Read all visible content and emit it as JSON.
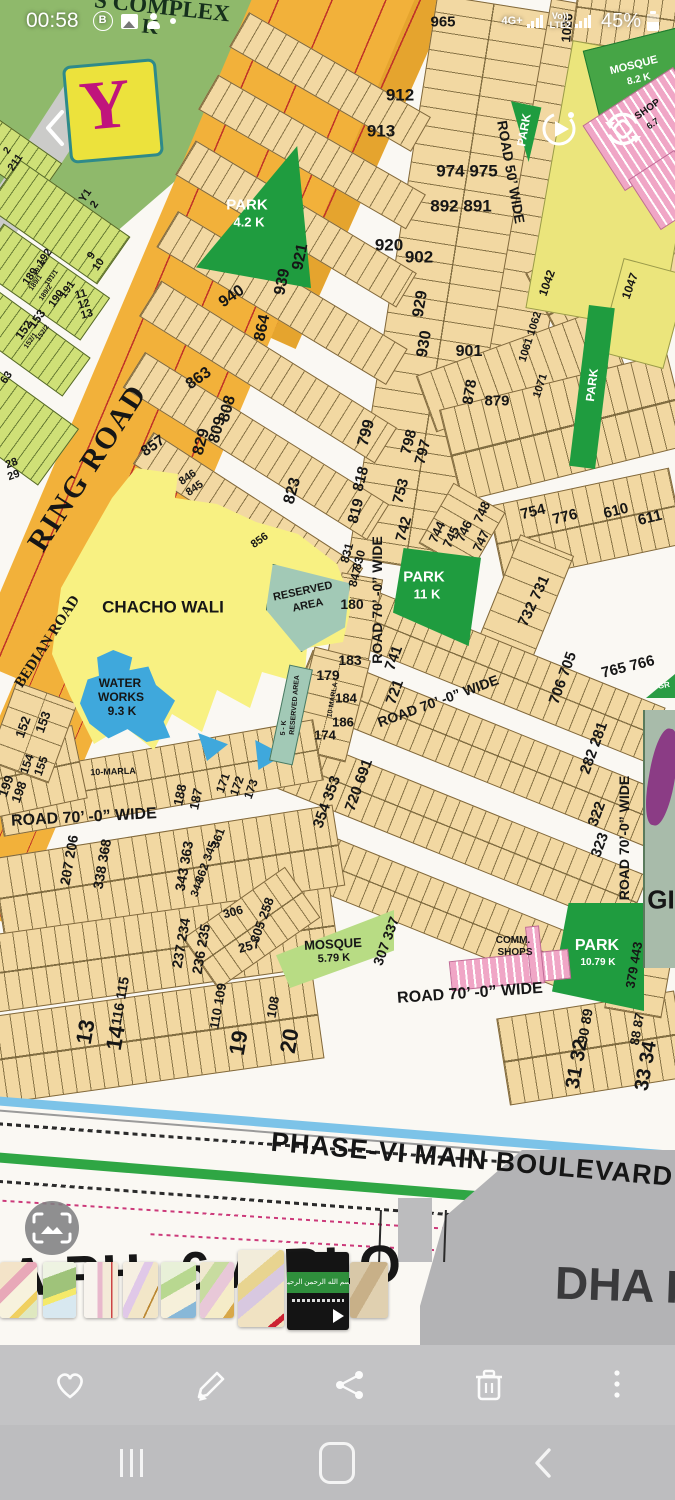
{
  "status_bar": {
    "time": "00:58",
    "network": "4G+",
    "volte": "Vo))",
    "lte": "LTE2",
    "battery": "45%",
    "notification_icons": [
      "b-app-icon",
      "gallery-icon",
      "digital-wellbeing-icon",
      "notification-dot"
    ]
  },
  "gallery": {
    "top_controls": [
      "back",
      "motion-photo",
      "rotate"
    ],
    "actions": [
      "favorite",
      "edit",
      "share",
      "delete",
      "more"
    ]
  },
  "nav_bar": {
    "items": [
      "recents",
      "home",
      "back"
    ]
  },
  "filmstrip": {
    "video_band_text": "بسم الله الرحمن الرحيم",
    "thumbs": [
      {
        "kind": "map",
        "x": 0,
        "y": 1262,
        "w": 37,
        "h": 56,
        "style": "th0"
      },
      {
        "kind": "map",
        "x": 43,
        "y": 1262,
        "w": 33,
        "h": 56,
        "style": "th1"
      },
      {
        "kind": "map",
        "x": 84,
        "y": 1262,
        "w": 34,
        "h": 56,
        "style": "th2"
      },
      {
        "kind": "map",
        "x": 123,
        "y": 1262,
        "w": 35,
        "h": 56,
        "style": "th3"
      },
      {
        "kind": "map",
        "x": 161,
        "y": 1262,
        "w": 35,
        "h": 56,
        "style": "th4"
      },
      {
        "kind": "map",
        "x": 200,
        "y": 1262,
        "w": 34,
        "h": 56,
        "style": "th5"
      },
      {
        "kind": "map",
        "x": 238,
        "y": 1250,
        "w": 46,
        "h": 77,
        "style": "th6"
      },
      {
        "kind": "video",
        "x": 287,
        "y": 1252,
        "w": 62,
        "h": 78,
        "style": "thv"
      },
      {
        "kind": "map",
        "x": 350,
        "y": 1262,
        "w": 38,
        "h": 56,
        "style": "th7"
      }
    ]
  },
  "map": {
    "logo": "Y",
    "bottom_title_partial": "A PH -6 A BLO",
    "next_image_title": "DHA P",
    "labels": [
      {
        "t": "S COMPLEX",
        "x": 162,
        "y": 7,
        "r": 6,
        "s": 23,
        "c": "#16301c",
        "f": 1
      },
      {
        "t": "K",
        "x": 150,
        "y": 27,
        "r": 6,
        "s": 21,
        "c": "#16301c",
        "f": 1
      },
      {
        "t": "965",
        "x": 443,
        "y": 22,
        "r": 0,
        "s": 15
      },
      {
        "t": "1026",
        "x": 567,
        "y": 28,
        "r": -85,
        "s": 13
      },
      {
        "t": "912",
        "x": 400,
        "y": 95,
        "r": 0,
        "s": 17
      },
      {
        "t": "913",
        "x": 381,
        "y": 131,
        "r": 0,
        "s": 17
      },
      {
        "t": "974 975",
        "x": 467,
        "y": 171,
        "r": 0,
        "s": 17
      },
      {
        "t": "892 891",
        "x": 461,
        "y": 206,
        "r": 0,
        "s": 17
      },
      {
        "t": "920",
        "x": 389,
        "y": 245,
        "r": 0,
        "s": 17
      },
      {
        "t": "902",
        "x": 419,
        "y": 257,
        "r": 0,
        "s": 17
      },
      {
        "t": "921",
        "x": 301,
        "y": 257,
        "r": -78,
        "s": 16
      },
      {
        "t": "939",
        "x": 283,
        "y": 282,
        "r": -78,
        "s": 16
      },
      {
        "t": "940",
        "x": 232,
        "y": 297,
        "r": -35,
        "s": 16
      },
      {
        "t": "864",
        "x": 263,
        "y": 328,
        "r": -78,
        "s": 16
      },
      {
        "t": "929",
        "x": 421,
        "y": 304,
        "r": -80,
        "s": 16
      },
      {
        "t": "930",
        "x": 425,
        "y": 344,
        "r": -80,
        "s": 16
      },
      {
        "t": "901",
        "x": 469,
        "y": 352,
        "r": 0,
        "s": 16
      },
      {
        "t": "863",
        "x": 199,
        "y": 379,
        "r": -35,
        "s": 16
      },
      {
        "t": "808",
        "x": 228,
        "y": 409,
        "r": -75,
        "s": 16
      },
      {
        "t": "878",
        "x": 470,
        "y": 392,
        "r": -80,
        "s": 15
      },
      {
        "t": "879",
        "x": 497,
        "y": 401,
        "r": 0,
        "s": 15
      },
      {
        "t": "829",
        "x": 202,
        "y": 442,
        "r": -75,
        "s": 16
      },
      {
        "t": "809",
        "x": 218,
        "y": 430,
        "r": -75,
        "s": 16
      },
      {
        "t": "799",
        "x": 367,
        "y": 433,
        "r": -75,
        "s": 16
      },
      {
        "t": "798",
        "x": 409,
        "y": 442,
        "r": -75,
        "s": 15
      },
      {
        "t": "797",
        "x": 423,
        "y": 452,
        "r": -75,
        "s": 15
      },
      {
        "t": "857",
        "x": 153,
        "y": 446,
        "r": -35,
        "s": 15
      },
      {
        "t": "846",
        "x": 188,
        "y": 478,
        "r": -35,
        "s": 11
      },
      {
        "t": "845",
        "x": 195,
        "y": 489,
        "r": -35,
        "s": 11
      },
      {
        "t": "823",
        "x": 293,
        "y": 491,
        "r": -75,
        "s": 16
      },
      {
        "t": "818",
        "x": 361,
        "y": 479,
        "r": -75,
        "s": 15
      },
      {
        "t": "819",
        "x": 356,
        "y": 511,
        "r": -75,
        "s": 15
      },
      {
        "t": "753",
        "x": 401,
        "y": 491,
        "r": -75,
        "s": 15
      },
      {
        "t": "742",
        "x": 404,
        "y": 529,
        "r": -75,
        "s": 15
      },
      {
        "t": "744",
        "x": 437,
        "y": 532,
        "r": -65,
        "s": 13
      },
      {
        "t": "745",
        "x": 451,
        "y": 537,
        "r": -65,
        "s": 13
      },
      {
        "t": "746",
        "x": 464,
        "y": 531,
        "r": -65,
        "s": 13
      },
      {
        "t": "747",
        "x": 481,
        "y": 541,
        "r": -65,
        "s": 13
      },
      {
        "t": "748",
        "x": 482,
        "y": 512,
        "r": -65,
        "s": 13
      },
      {
        "t": "754",
        "x": 533,
        "y": 512,
        "r": -14,
        "s": 15
      },
      {
        "t": "776",
        "x": 565,
        "y": 517,
        "r": -14,
        "s": 15
      },
      {
        "t": "610",
        "x": 616,
        "y": 511,
        "r": -14,
        "s": 15
      },
      {
        "t": "611",
        "x": 650,
        "y": 518,
        "r": -14,
        "s": 15
      },
      {
        "t": "856",
        "x": 260,
        "y": 541,
        "r": -35,
        "s": 11
      },
      {
        "t": "831",
        "x": 347,
        "y": 553,
        "r": -75,
        "s": 12
      },
      {
        "t": "830",
        "x": 359,
        "y": 560,
        "r": -75,
        "s": 12
      },
      {
        "t": "847",
        "x": 355,
        "y": 577,
        "r": -75,
        "s": 12
      },
      {
        "t": "180",
        "x": 352,
        "y": 604,
        "r": 0,
        "s": 14
      },
      {
        "t": "183",
        "x": 350,
        "y": 660,
        "r": 0,
        "s": 14
      },
      {
        "t": "732 731",
        "x": 534,
        "y": 601,
        "r": -65,
        "s": 15
      },
      {
        "t": "179",
        "x": 328,
        "y": 675,
        "r": 0,
        "s": 14
      },
      {
        "t": "184",
        "x": 346,
        "y": 698,
        "r": 0,
        "s": 13
      },
      {
        "t": "186",
        "x": 343,
        "y": 722,
        "r": 0,
        "s": 13
      },
      {
        "t": "174",
        "x": 325,
        "y": 735,
        "r": 0,
        "s": 13
      },
      {
        "t": "10-MARLA",
        "x": 333,
        "y": 700,
        "r": -80,
        "s": 7
      },
      {
        "t": "RESERVED AREA",
        "x": 295,
        "y": 705,
        "r": -85,
        "s": 7
      },
      {
        "t": "5 - K",
        "x": 284,
        "y": 728,
        "r": -85,
        "s": 7
      },
      {
        "t": "RESERVED",
        "x": 303,
        "y": 592,
        "r": -12,
        "s": 11
      },
      {
        "t": "AREA",
        "x": 308,
        "y": 606,
        "r": -12,
        "s": 11
      },
      {
        "t": "CHACHO WALI",
        "x": 163,
        "y": 607,
        "r": 0,
        "s": 17
      },
      {
        "t": "WATER",
        "x": 120,
        "y": 683,
        "r": 0,
        "s": 12
      },
      {
        "t": "WORKS",
        "x": 121,
        "y": 697,
        "r": 0,
        "s": 12
      },
      {
        "t": "9.3 K",
        "x": 122,
        "y": 711,
        "r": 0,
        "s": 12
      },
      {
        "t": "RING ROAD",
        "x": 88,
        "y": 468,
        "r": -57,
        "s": 30,
        "f": 1,
        "ls": 2
      },
      {
        "t": "BEDIAN ROAD",
        "x": 48,
        "y": 642,
        "r": -57,
        "s": 15,
        "f": 1
      },
      {
        "t": "PARK",
        "x": 247,
        "y": 205,
        "r": 0,
        "s": 15,
        "c": "#ffffff"
      },
      {
        "t": "4.2 K",
        "x": 249,
        "y": 222,
        "r": 0,
        "s": 13,
        "c": "#ffffff"
      },
      {
        "t": "PARK",
        "x": 424,
        "y": 577,
        "r": 0,
        "s": 15,
        "c": "#ffffff"
      },
      {
        "t": "11 K",
        "x": 427,
        "y": 594,
        "r": 0,
        "s": 13,
        "c": "#ffffff"
      },
      {
        "t": "PARK",
        "x": 524,
        "y": 130,
        "r": -80,
        "s": 12,
        "c": "#ffffff"
      },
      {
        "t": "PARK",
        "x": 592,
        "y": 385,
        "r": -83,
        "s": 12,
        "c": "#ffffff"
      },
      {
        "t": "MOSQUE",
        "x": 634,
        "y": 66,
        "r": -14,
        "s": 11,
        "c": "#ffffff"
      },
      {
        "t": "8.2 K",
        "x": 639,
        "y": 80,
        "r": -14,
        "s": 10,
        "c": "#ffffff"
      },
      {
        "t": "SHOP",
        "x": 648,
        "y": 110,
        "r": -35,
        "s": 10
      },
      {
        "t": "6.7",
        "x": 653,
        "y": 124,
        "r": -35,
        "s": 9
      },
      {
        "t": "1042",
        "x": 547,
        "y": 283,
        "r": -70,
        "s": 12
      },
      {
        "t": "1047",
        "x": 630,
        "y": 286,
        "r": -70,
        "s": 12
      },
      {
        "t": "1061 1062",
        "x": 531,
        "y": 337,
        "r": -72,
        "s": 11
      },
      {
        "t": "1071",
        "x": 541,
        "y": 386,
        "r": -72,
        "s": 11
      },
      {
        "t": "ROAD 50’ WIDE",
        "x": 511,
        "y": 172,
        "r": 80,
        "s": 14
      },
      {
        "t": "ROAD 70’ -0” WIDE",
        "x": 377,
        "y": 600,
        "r": -90,
        "s": 14
      },
      {
        "t": "ROAD 70’ -0” WIDE",
        "x": 438,
        "y": 701,
        "r": -20,
        "s": 14
      },
      {
        "t": "ROAD 70’ -0” WIDE",
        "x": 84,
        "y": 818,
        "r": -3,
        "s": 16
      },
      {
        "t": "ROAD 70’ -0” WIDE",
        "x": 470,
        "y": 994,
        "r": -4,
        "s": 16
      },
      {
        "t": "ROAD 70’-0” WIDE",
        "x": 624,
        "y": 838,
        "r": -90,
        "s": 14
      },
      {
        "t": "741",
        "x": 394,
        "y": 658,
        "r": -70,
        "s": 15
      },
      {
        "t": "721",
        "x": 395,
        "y": 692,
        "r": -70,
        "s": 15
      },
      {
        "t": "706 705",
        "x": 563,
        "y": 678,
        "r": -70,
        "s": 15
      },
      {
        "t": "765 766",
        "x": 628,
        "y": 667,
        "r": -14,
        "s": 15
      },
      {
        "t": "720 691",
        "x": 359,
        "y": 785,
        "r": -70,
        "s": 15
      },
      {
        "t": "354 353",
        "x": 327,
        "y": 802,
        "r": -70,
        "s": 15
      },
      {
        "t": "282 281",
        "x": 594,
        "y": 748,
        "r": -70,
        "s": 15
      },
      {
        "t": "322",
        "x": 597,
        "y": 814,
        "r": -70,
        "s": 15
      },
      {
        "t": "323",
        "x": 600,
        "y": 845,
        "r": -70,
        "s": 15
      },
      {
        "t": "GR",
        "x": 664,
        "y": 686,
        "r": -10,
        "s": 8,
        "c": "#ffffff"
      },
      {
        "t": "GI",
        "x": 661,
        "y": 900,
        "r": 0,
        "s": 26
      },
      {
        "t": "152",
        "x": 23,
        "y": 727,
        "r": -70,
        "s": 13
      },
      {
        "t": "153",
        "x": 43,
        "y": 722,
        "r": -70,
        "s": 13
      },
      {
        "t": "154",
        "x": 27,
        "y": 764,
        "r": -70,
        "s": 12
      },
      {
        "t": "155",
        "x": 41,
        "y": 766,
        "r": -70,
        "s": 12
      },
      {
        "t": "198",
        "x": 19,
        "y": 792,
        "r": -70,
        "s": 13
      },
      {
        "t": "199",
        "x": 6,
        "y": 786,
        "r": -70,
        "s": 13
      },
      {
        "t": "10-MARLA",
        "x": 113,
        "y": 772,
        "r": -2,
        "s": 9
      },
      {
        "t": "188",
        "x": 180,
        "y": 795,
        "r": -78,
        "s": 13
      },
      {
        "t": "187",
        "x": 196,
        "y": 799,
        "r": -78,
        "s": 13
      },
      {
        "t": "171",
        "x": 223,
        "y": 783,
        "r": -70,
        "s": 12
      },
      {
        "t": "172",
        "x": 237,
        "y": 786,
        "r": -70,
        "s": 12
      },
      {
        "t": "173",
        "x": 251,
        "y": 789,
        "r": -70,
        "s": 12
      },
      {
        "t": "207 206",
        "x": 69,
        "y": 860,
        "r": -80,
        "s": 14
      },
      {
        "t": "338 368",
        "x": 102,
        "y": 864,
        "r": -80,
        "s": 14
      },
      {
        "t": "343 363",
        "x": 184,
        "y": 866,
        "r": -80,
        "s": 14
      },
      {
        "t": "362 345",
        "x": 206,
        "y": 862,
        "r": -70,
        "s": 12
      },
      {
        "t": "361",
        "x": 218,
        "y": 838,
        "r": -70,
        "s": 12
      },
      {
        "t": "344",
        "x": 198,
        "y": 888,
        "r": -70,
        "s": 11
      },
      {
        "t": "306",
        "x": 233,
        "y": 912,
        "r": -15,
        "s": 12
      },
      {
        "t": "305 258",
        "x": 262,
        "y": 920,
        "r": -70,
        "s": 13
      },
      {
        "t": "257",
        "x": 249,
        "y": 946,
        "r": -15,
        "s": 13
      },
      {
        "t": "237 234",
        "x": 181,
        "y": 943,
        "r": -80,
        "s": 14
      },
      {
        "t": "236 235",
        "x": 201,
        "y": 949,
        "r": -80,
        "s": 14
      },
      {
        "t": "116 115",
        "x": 120,
        "y": 1001,
        "r": -80,
        "s": 14
      },
      {
        "t": "110 109",
        "x": 218,
        "y": 1006,
        "r": -80,
        "s": 13
      },
      {
        "t": "108",
        "x": 273,
        "y": 1007,
        "r": -80,
        "s": 13
      },
      {
        "t": "13",
        "x": 86,
        "y": 1032,
        "r": -80,
        "s": 22
      },
      {
        "t": "14",
        "x": 116,
        "y": 1038,
        "r": -80,
        "s": 22
      },
      {
        "t": "19",
        "x": 239,
        "y": 1043,
        "r": -80,
        "s": 22
      },
      {
        "t": "20",
        "x": 290,
        "y": 1041,
        "r": -80,
        "s": 22
      },
      {
        "t": "307 337",
        "x": 386,
        "y": 941,
        "r": -70,
        "s": 14
      },
      {
        "t": "MOSQUE",
        "x": 333,
        "y": 944,
        "r": -3,
        "s": 13
      },
      {
        "t": "5.79 K",
        "x": 334,
        "y": 959,
        "r": -3,
        "s": 11
      },
      {
        "t": "COMM.",
        "x": 513,
        "y": 941,
        "r": 0,
        "s": 10
      },
      {
        "t": "SHOPS",
        "x": 515,
        "y": 953,
        "r": 0,
        "s": 10
      },
      {
        "t": "PARK",
        "x": 597,
        "y": 946,
        "r": 0,
        "s": 16,
        "c": "#ffffff"
      },
      {
        "t": "10.79 K",
        "x": 598,
        "y": 963,
        "r": 0,
        "s": 10,
        "c": "#ffffff"
      },
      {
        "t": "379 443",
        "x": 634,
        "y": 965,
        "r": -80,
        "s": 13
      },
      {
        "t": "90 89",
        "x": 585,
        "y": 1026,
        "r": -80,
        "s": 14
      },
      {
        "t": "31 32",
        "x": 577,
        "y": 1064,
        "r": -80,
        "s": 20
      },
      {
        "t": "88 87",
        "x": 637,
        "y": 1029,
        "r": -80,
        "s": 13
      },
      {
        "t": "33 34",
        "x": 646,
        "y": 1066,
        "r": -80,
        "s": 20
      },
      {
        "t": "Y1",
        "x": 86,
        "y": 196,
        "r": -55,
        "s": 11
      },
      {
        "t": "2",
        "x": 95,
        "y": 205,
        "r": -55,
        "s": 11
      },
      {
        "t": "211",
        "x": 16,
        "y": 163,
        "r": -55,
        "s": 11
      },
      {
        "t": "2",
        "x": 8,
        "y": 151,
        "r": -55,
        "s": 10
      },
      {
        "t": "192",
        "x": 45,
        "y": 258,
        "r": -55,
        "s": 11
      },
      {
        "t": "189",
        "x": 31,
        "y": 277,
        "r": -55,
        "s": 11
      },
      {
        "t": "190",
        "x": 57,
        "y": 299,
        "r": -55,
        "s": 11
      },
      {
        "t": "191",
        "x": 68,
        "y": 290,
        "r": -55,
        "s": 11
      },
      {
        "t": "191/2",
        "x": 40,
        "y": 268,
        "r": -55,
        "s": 7
      },
      {
        "t": "189/1",
        "x": 36,
        "y": 283,
        "r": -55,
        "s": 7
      },
      {
        "t": "191/1",
        "x": 52,
        "y": 278,
        "r": -55,
        "s": 7
      },
      {
        "t": "189/2",
        "x": 46,
        "y": 293,
        "r": -55,
        "s": 7
      },
      {
        "t": "9",
        "x": 92,
        "y": 256,
        "r": -55,
        "s": 11
      },
      {
        "t": "10",
        "x": 99,
        "y": 265,
        "r": -55,
        "s": 11
      },
      {
        "t": "11",
        "x": 81,
        "y": 295,
        "r": -15,
        "s": 11
      },
      {
        "t": "12",
        "x": 84,
        "y": 305,
        "r": -15,
        "s": 11
      },
      {
        "t": "13",
        "x": 87,
        "y": 315,
        "r": -15,
        "s": 11
      },
      {
        "t": "152",
        "x": 24,
        "y": 330,
        "r": -55,
        "s": 12
      },
      {
        "t": "153",
        "x": 37,
        "y": 319,
        "r": -55,
        "s": 12
      },
      {
        "t": "152/1",
        "x": 31,
        "y": 341,
        "r": -55,
        "s": 7
      },
      {
        "t": "152/2",
        "x": 43,
        "y": 333,
        "r": -55,
        "s": 7
      },
      {
        "t": "63",
        "x": 7,
        "y": 378,
        "r": -55,
        "s": 11
      },
      {
        "t": "28",
        "x": 12,
        "y": 464,
        "r": -20,
        "s": 11
      },
      {
        "t": "29",
        "x": 14,
        "y": 476,
        "r": -20,
        "s": 11
      },
      {
        "t": "PHASE-VI MAIN BOULEVARD",
        "x": 472,
        "y": 1160,
        "r": 5,
        "s": 27,
        "ls": 1
      }
    ]
  }
}
